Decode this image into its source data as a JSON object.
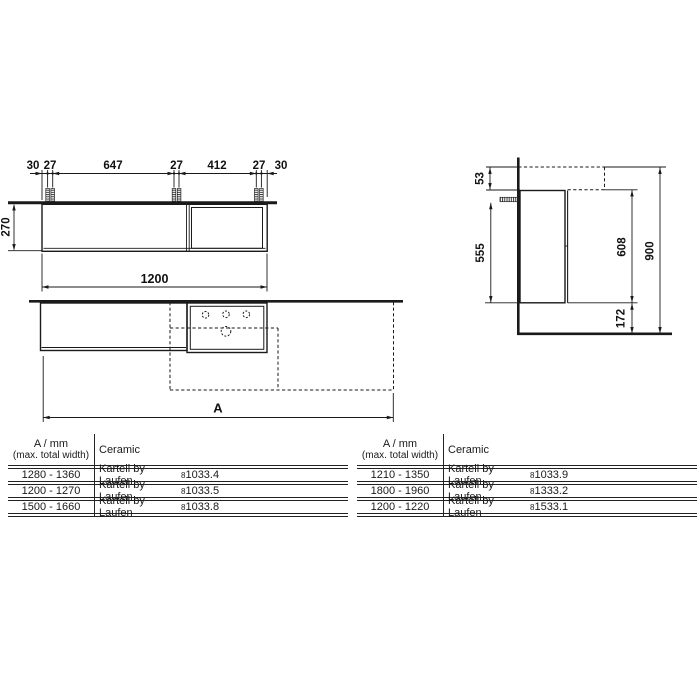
{
  "front_view": {
    "top_dims": [
      "30",
      "27",
      "647",
      "27",
      "412",
      "27",
      "30"
    ],
    "height_dim": "270",
    "width_dim": "1200"
  },
  "side_view": {
    "ceramic_top_offset": "53",
    "cabinet_height": "555",
    "cabinet_with_ceramic_height": "608",
    "total_height": "900",
    "bottom_clearance": "172"
  },
  "plan_view": {
    "width_label": "A"
  },
  "colors": {
    "line": "#1a1a1a",
    "background": "#ffffff"
  },
  "tables": [
    {
      "col1_header_line1": "A / mm",
      "col1_header_line2": "(max. total width)",
      "col2_header": "Ceramic",
      "rows": [
        {
          "range": "1280 - 1360",
          "brand": "Kartell by Laufen",
          "code_prefix": "8",
          "code": "1033.4"
        },
        {
          "range": "1200 - 1270",
          "brand": "Kartell by Laufen",
          "code_prefix": "8",
          "code": "1033.5"
        },
        {
          "range": "1500 - 1660",
          "brand": "Kartell by Laufen",
          "code_prefix": "8",
          "code": "1033.8"
        }
      ]
    },
    {
      "col1_header_line1": "A / mm",
      "col1_header_line2": "(max. total width)",
      "col2_header": "Ceramic",
      "rows": [
        {
          "range": "1210 - 1350",
          "brand": "Kartell by Laufen",
          "code_prefix": "8",
          "code": "1033.9"
        },
        {
          "range": "1800 - 1960",
          "brand": "Kartell by Laufen",
          "code_prefix": "8",
          "code": "1333.2"
        },
        {
          "range": "1200 - 1220",
          "brand": "Kartell by Laufen",
          "code_prefix": "8",
          "code": "1533.1"
        }
      ]
    }
  ]
}
